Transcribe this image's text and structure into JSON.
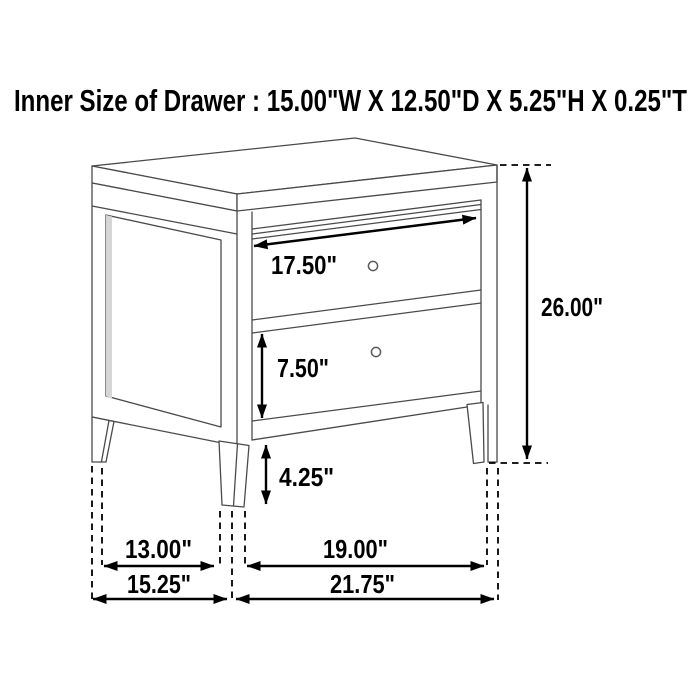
{
  "title": "Inner Size of Drawer : 15.00\"W X 12.50\"D X 5.25\"H X 0.25\"T",
  "inner_drawer_size": {
    "width": "15.00\"W",
    "depth": "12.50\"D",
    "height": "5.25\"H",
    "thickness": "0.25\"T"
  },
  "figure": {
    "subject": "two-drawer nightstand technical line drawing",
    "drawer_count": "2"
  },
  "dimensions": {
    "drawer_width": "17.50\"",
    "lower_drawer_height": "7.50\"",
    "leg_clearance": "4.25\"",
    "overall_height": "26.00\"",
    "depth_between_legs": "13.00\"",
    "width_between_legs": "19.00\"",
    "overall_depth": "15.25\"",
    "overall_width": "21.75\""
  },
  "colors": {
    "background": "#ffffff",
    "artwork_line": "#4a4a4a",
    "dimension_ink": "#000000",
    "panel_shade": "#d6d6d6"
  }
}
